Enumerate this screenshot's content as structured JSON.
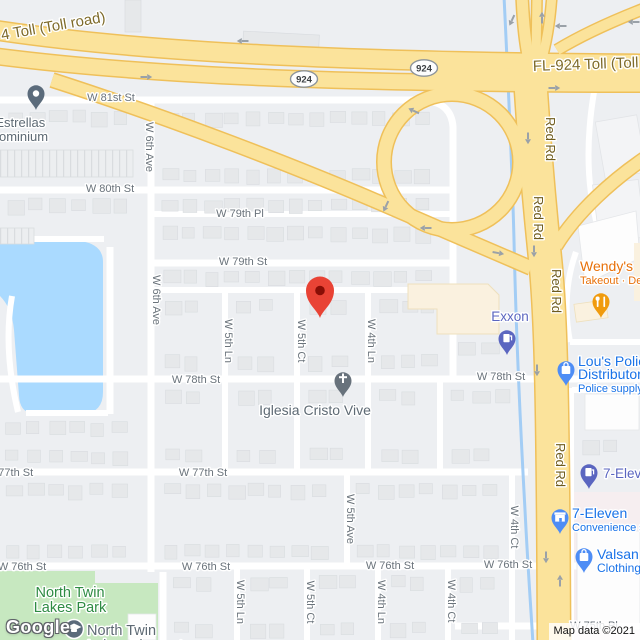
{
  "map": {
    "watermark": "Google",
    "attribution": "Map data ©2021",
    "colors": {
      "water": "#AADAFF",
      "park": "#C7E8C0",
      "park_text": "#2E8B43",
      "highway_fill": "#FBE39B",
      "highway_casing": "#EFC05A",
      "street": "#FFFFFF",
      "street_label": "#6A737B",
      "highway_label": "#7E6B2A",
      "red_rd_label": "#6F5C1E",
      "poi_blue": "#1A73E8",
      "poi_indigo": "#5B66C0",
      "poi_orange": "#E8710A",
      "poi_grey": "#5E6A74",
      "pin_blue": "#4E8DF5",
      "pin_grey": "#5B6B7B",
      "destination_red": "#E94335",
      "canal": "#A3CDF5",
      "commercial": "#FAF1DF"
    },
    "shields": [
      {
        "label": "924",
        "x": 304,
        "y": 79
      },
      {
        "label": "924",
        "x": 424,
        "y": 68
      }
    ],
    "highway_labels": [
      {
        "text": "4 Toll (Toll road)",
        "x": 2,
        "y": 40,
        "rot": -10,
        "s": 15,
        "c": "#7E6B2A",
        "a": "start"
      },
      {
        "text": "FL-924 Toll (Toll road)",
        "x": 533,
        "y": 71,
        "rot": -2,
        "s": 15,
        "c": "#7E6B2A",
        "a": "start"
      },
      {
        "text": "Red Rd",
        "x": 546,
        "y": 139,
        "rot": 90,
        "s": 13,
        "c": "#6F5C1E",
        "a": "middle"
      },
      {
        "text": "Red Rd",
        "x": 534,
        "y": 218,
        "rot": 90,
        "s": 13,
        "c": "#6F5C1E",
        "a": "middle"
      },
      {
        "text": "Red Rd",
        "x": 552,
        "y": 291,
        "rot": 90,
        "s": 13,
        "c": "#6F5C1E",
        "a": "middle"
      },
      {
        "text": "Red Rd",
        "x": 556,
        "y": 465,
        "rot": 90,
        "s": 13,
        "c": "#6F5C1E",
        "a": "middle"
      }
    ],
    "street_labels": [
      {
        "text": "W 81st St",
        "x": 111,
        "y": 101
      },
      {
        "text": "W 80th St",
        "x": 110,
        "y": 192
      },
      {
        "text": "W 79th Pl",
        "x": 240,
        "y": 217
      },
      {
        "text": "W 79th St",
        "x": 243,
        "y": 265
      },
      {
        "text": "W 78th St",
        "x": 196,
        "y": 383
      },
      {
        "text": "W 78th St",
        "x": 501,
        "y": 380
      },
      {
        "text": "W 77th St",
        "x": 9,
        "y": 476
      },
      {
        "text": "W 77th St",
        "x": 203,
        "y": 476
      },
      {
        "text": "W 76th St",
        "x": 22,
        "y": 570
      },
      {
        "text": "W 76th St",
        "x": 206,
        "y": 570
      },
      {
        "text": "W 76th St",
        "x": 390,
        "y": 569
      },
      {
        "text": "W 76th St",
        "x": 508,
        "y": 568
      },
      {
        "text": "W 75th Pl",
        "x": 594,
        "y": 629
      },
      {
        "text": "W 6th Ave",
        "x": 146,
        "y": 147,
        "rot": 90
      },
      {
        "text": "W 6th Ave",
        "x": 153,
        "y": 300,
        "rot": 90
      },
      {
        "text": "W 5th Ln",
        "x": 225,
        "y": 341,
        "rot": 90
      },
      {
        "text": "W 5th Ct",
        "x": 298,
        "y": 341,
        "rot": 90
      },
      {
        "text": "W 4th Ln",
        "x": 368,
        "y": 341,
        "rot": 90
      },
      {
        "text": "W 5th Ave",
        "x": 347,
        "y": 519,
        "rot": 90
      },
      {
        "text": "W 4th Ct",
        "x": 511,
        "y": 527,
        "rot": 90
      },
      {
        "text": "W 5th Ln",
        "x": 237,
        "y": 602,
        "rot": 90
      },
      {
        "text": "W 5th Ct",
        "x": 307,
        "y": 602,
        "rot": 90
      },
      {
        "text": "W 4th Ln",
        "x": 378,
        "y": 602,
        "rot": 90
      },
      {
        "text": "W 4th Ct",
        "x": 448,
        "y": 601,
        "rot": 90
      }
    ],
    "pois": [
      {
        "id": "las-estrellas-condominium",
        "a": "middle",
        "x": 8,
        "y": 127,
        "lh": 14,
        "c": "#5E6A74",
        "lines": [
          {
            "t": "Las Estrellas",
            "s": 13,
            "w": 400
          },
          {
            "t": "Condominium",
            "s": 13,
            "w": 400
          }
        ],
        "pin": {
          "kind": "generic",
          "x": 36,
          "y": 110,
          "c": "#5B6B7B"
        }
      },
      {
        "id": "wendys",
        "a": "start",
        "x": 580,
        "y": 271,
        "lh": 13,
        "c": "#E8710A",
        "lines": [
          {
            "t": "Wendy's",
            "s": 14,
            "w": 500
          },
          {
            "t": "Takeout · Delivery",
            "s": 11,
            "w": 400
          }
        ],
        "pin": {
          "kind": "restaurant",
          "x": 601,
          "y": 318,
          "c": "#F09B0E"
        }
      },
      {
        "id": "exxon",
        "a": "middle",
        "x": 510,
        "y": 321,
        "lh": 14,
        "c": "#5B66C0",
        "lines": [
          {
            "t": "Exxon",
            "s": 13.5,
            "w": 500
          }
        ],
        "pin": {
          "kind": "gas",
          "x": 507,
          "y": 355,
          "c": "#5B66C0"
        }
      },
      {
        "id": "lous-police-distributors",
        "a": "start",
        "x": 578,
        "y": 366,
        "lh": 13,
        "c": "#1A73E8",
        "lines": [
          {
            "t": "Lou's Police",
            "s": 14,
            "w": 500
          },
          {
            "t": "Distributors",
            "s": 14,
            "w": 500
          },
          {
            "t": "Police supply store",
            "s": 11,
            "w": 400
          }
        ],
        "pin": {
          "kind": "bag",
          "x": 566,
          "y": 386,
          "c": "#4E8DF5"
        }
      },
      {
        "id": "seven-eleven-fuel",
        "a": "start",
        "x": 603,
        "y": 478,
        "lh": 14,
        "c": "#5B66C0",
        "lines": [
          {
            "t": "7-Eleven",
            "s": 13.5,
            "w": 500
          }
        ],
        "pin": {
          "kind": "gas",
          "x": 589,
          "y": 489,
          "c": "#5B66C0"
        }
      },
      {
        "id": "seven-eleven",
        "a": "start",
        "x": 572,
        "y": 518,
        "lh": 13,
        "c": "#1A73E8",
        "lines": [
          {
            "t": "7-Eleven",
            "s": 14,
            "w": 500
          },
          {
            "t": "Convenience store",
            "s": 11,
            "w": 400
          }
        ],
        "pin": {
          "kind": "store",
          "x": 560,
          "y": 534,
          "c": "#4E8DF5"
        }
      },
      {
        "id": "valsan",
        "a": "start",
        "x": 597,
        "y": 559,
        "lh": 13,
        "c": "#1A73E8",
        "lines": [
          {
            "t": "Valsan",
            "s": 14,
            "w": 500
          },
          {
            "t": "Clothing store",
            "s": 12,
            "w": 400
          }
        ],
        "pin": {
          "kind": "bag",
          "x": 584,
          "y": 573,
          "c": "#4E8DF5"
        }
      },
      {
        "id": "iglesia-cristo-vive",
        "a": "middle",
        "x": 315,
        "y": 415,
        "lh": 14,
        "c": "#5E6A74",
        "lines": [
          {
            "t": "Iglesia Cristo Vive",
            "s": 14,
            "w": 400
          }
        ],
        "pin": {
          "kind": "church",
          "x": 343,
          "y": 397,
          "c": "#68727C"
        }
      },
      {
        "id": "north-twin-lakes-park",
        "a": "middle",
        "x": 70,
        "y": 597,
        "lh": 15,
        "c": "#2E8B43",
        "lines": [
          {
            "t": "North Twin",
            "s": 14.5,
            "w": 400
          },
          {
            "t": "Lakes Park",
            "s": 14.5,
            "w": 400
          }
        ]
      },
      {
        "id": "north-twin-lakes-elementary",
        "a": "start",
        "x": 87,
        "y": 635,
        "lh": 15,
        "c": "#5E6A74",
        "lines": [
          {
            "t": "North Twin",
            "s": 14.5,
            "w": 400
          },
          {
            "t": "Lakes Elementary",
            "s": 14.5,
            "w": 400
          }
        ],
        "pin": {
          "kind": "school",
          "x": 74,
          "y": 629,
          "c": "#5B6B7B"
        }
      }
    ],
    "destination": {
      "x": 320,
      "y": 318
    }
  }
}
